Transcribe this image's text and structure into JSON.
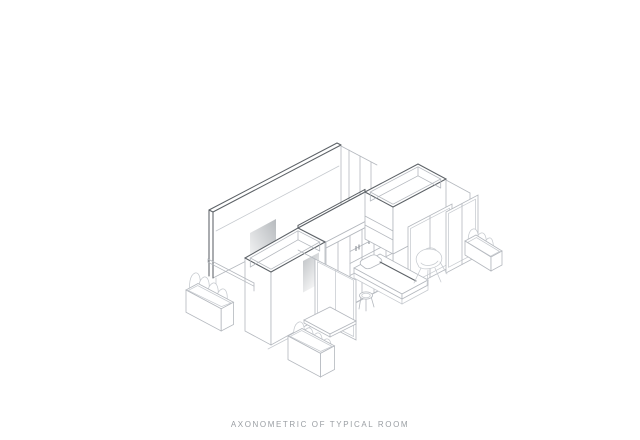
{
  "caption": {
    "text": "AXONOMETRIC OF TYPICAL ROOM"
  },
  "drawing": {
    "type": "axonometric-architectural-line-drawing",
    "subject": "typical room",
    "elements": [
      "back-wall",
      "bridge-shelf",
      "left-storage-pod",
      "right-storage-pod",
      "closet-grid",
      "sliding-panels",
      "bed",
      "pillow",
      "stool",
      "chair",
      "desk-shelf",
      "planter-left",
      "planter-center",
      "planter-right",
      "hand-rail"
    ]
  },
  "colors": {
    "line_light": "#b4b8be",
    "line_dark": "#5d6267",
    "line_faint": "#c6cacf",
    "shadow": "#8d9298",
    "caption_text": "#9a9ea3",
    "background": "#ffffff"
  }
}
